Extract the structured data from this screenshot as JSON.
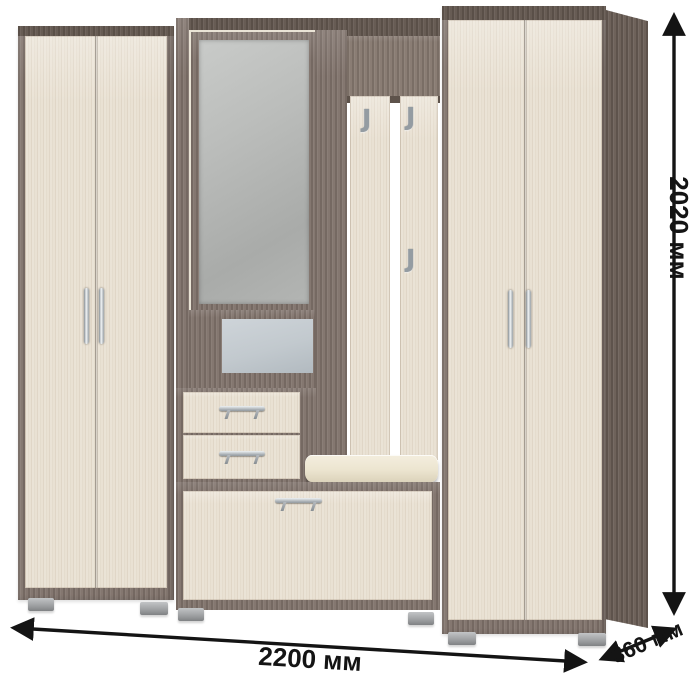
{
  "scene": {
    "description": "Hallway furniture set: two double-door wardrobes, central mirrored section with open niche and drawers, coat-hook panel with bench seat and shoe cabinet",
    "background_color": "#ffffff"
  },
  "dimensions": {
    "width": {
      "label": "2200 мм"
    },
    "height": {
      "label": "2020 мм"
    },
    "depth": {
      "label": "360 мм"
    }
  },
  "icons": {
    "coat_hook_glyph": "J"
  },
  "colors": {
    "frame_wood": "#847770",
    "frame_wood_dark": "#675c54",
    "door_light": "#e9e1d3",
    "mirror_glass": "#b3b5b3",
    "niche_back": "#c2c9ce",
    "cushion": "#ece5d0",
    "metal": "#aab0b5",
    "foot": "#9d9fa1",
    "arrow": "#141414",
    "bg": "#ffffff"
  }
}
